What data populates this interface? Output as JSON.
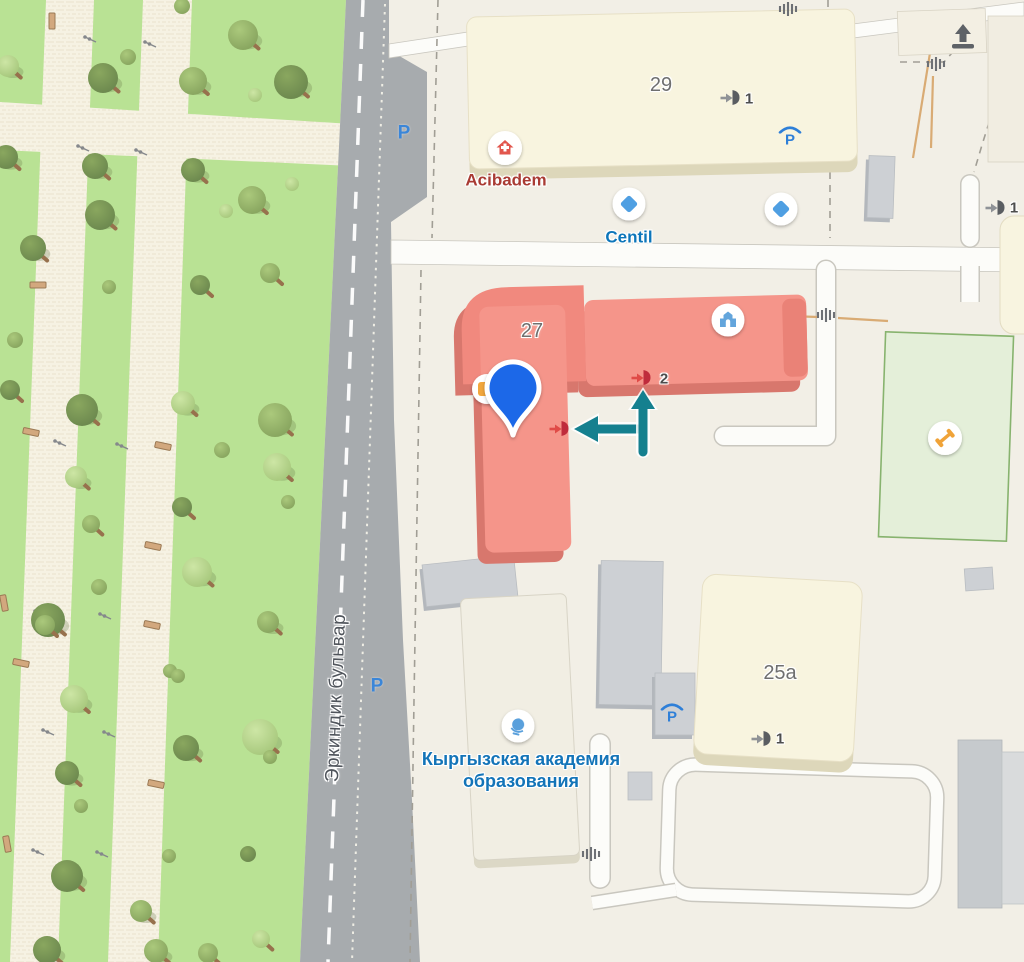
{
  "street": {
    "name": "Эркиндик бульвар"
  },
  "buildings": {
    "b29": {
      "number": "29",
      "entrance_number": "1"
    },
    "b27": {
      "number": "27",
      "entrance_number": "2",
      "highlighted": true
    },
    "b25a": {
      "number": "25a",
      "entrance_number": "1"
    },
    "right_building": {
      "entrance_number": "1"
    }
  },
  "parking": {
    "street_label": "P",
    "covered_label": "P"
  },
  "pois": {
    "acibadem": {
      "label": "Acibadem",
      "icon": "hospital-icon"
    },
    "centil": {
      "label": "Centil",
      "icon": "diamond-icon"
    },
    "centil_second": {
      "icon": "diamond-icon"
    },
    "academy": {
      "line1": "Кыргызская академия",
      "line2": "образования",
      "icon": "globe-icon"
    },
    "administrative": {
      "icon": "building-icon"
    },
    "sports_field": {
      "icon": "dumbbell-icon"
    }
  },
  "selected_marker": {
    "icon": "location-pin",
    "color": "#1b67e8"
  },
  "route_arrows": {
    "color": "#15808f",
    "directions": [
      "up-to-entrance-2",
      "left-to-entrance"
    ]
  },
  "map_icons": {
    "gate": "gate-icon",
    "stairs": "stairs-icon",
    "entrance": "entrance-icon"
  },
  "colors": {
    "background": "#f2efe6",
    "park": "#b9e294",
    "road": "#a7abae",
    "building_default": "#f8f4df",
    "building_highlight": "#f5948a",
    "sports_field": "#e4efd9",
    "path": "#fcfcf9"
  }
}
